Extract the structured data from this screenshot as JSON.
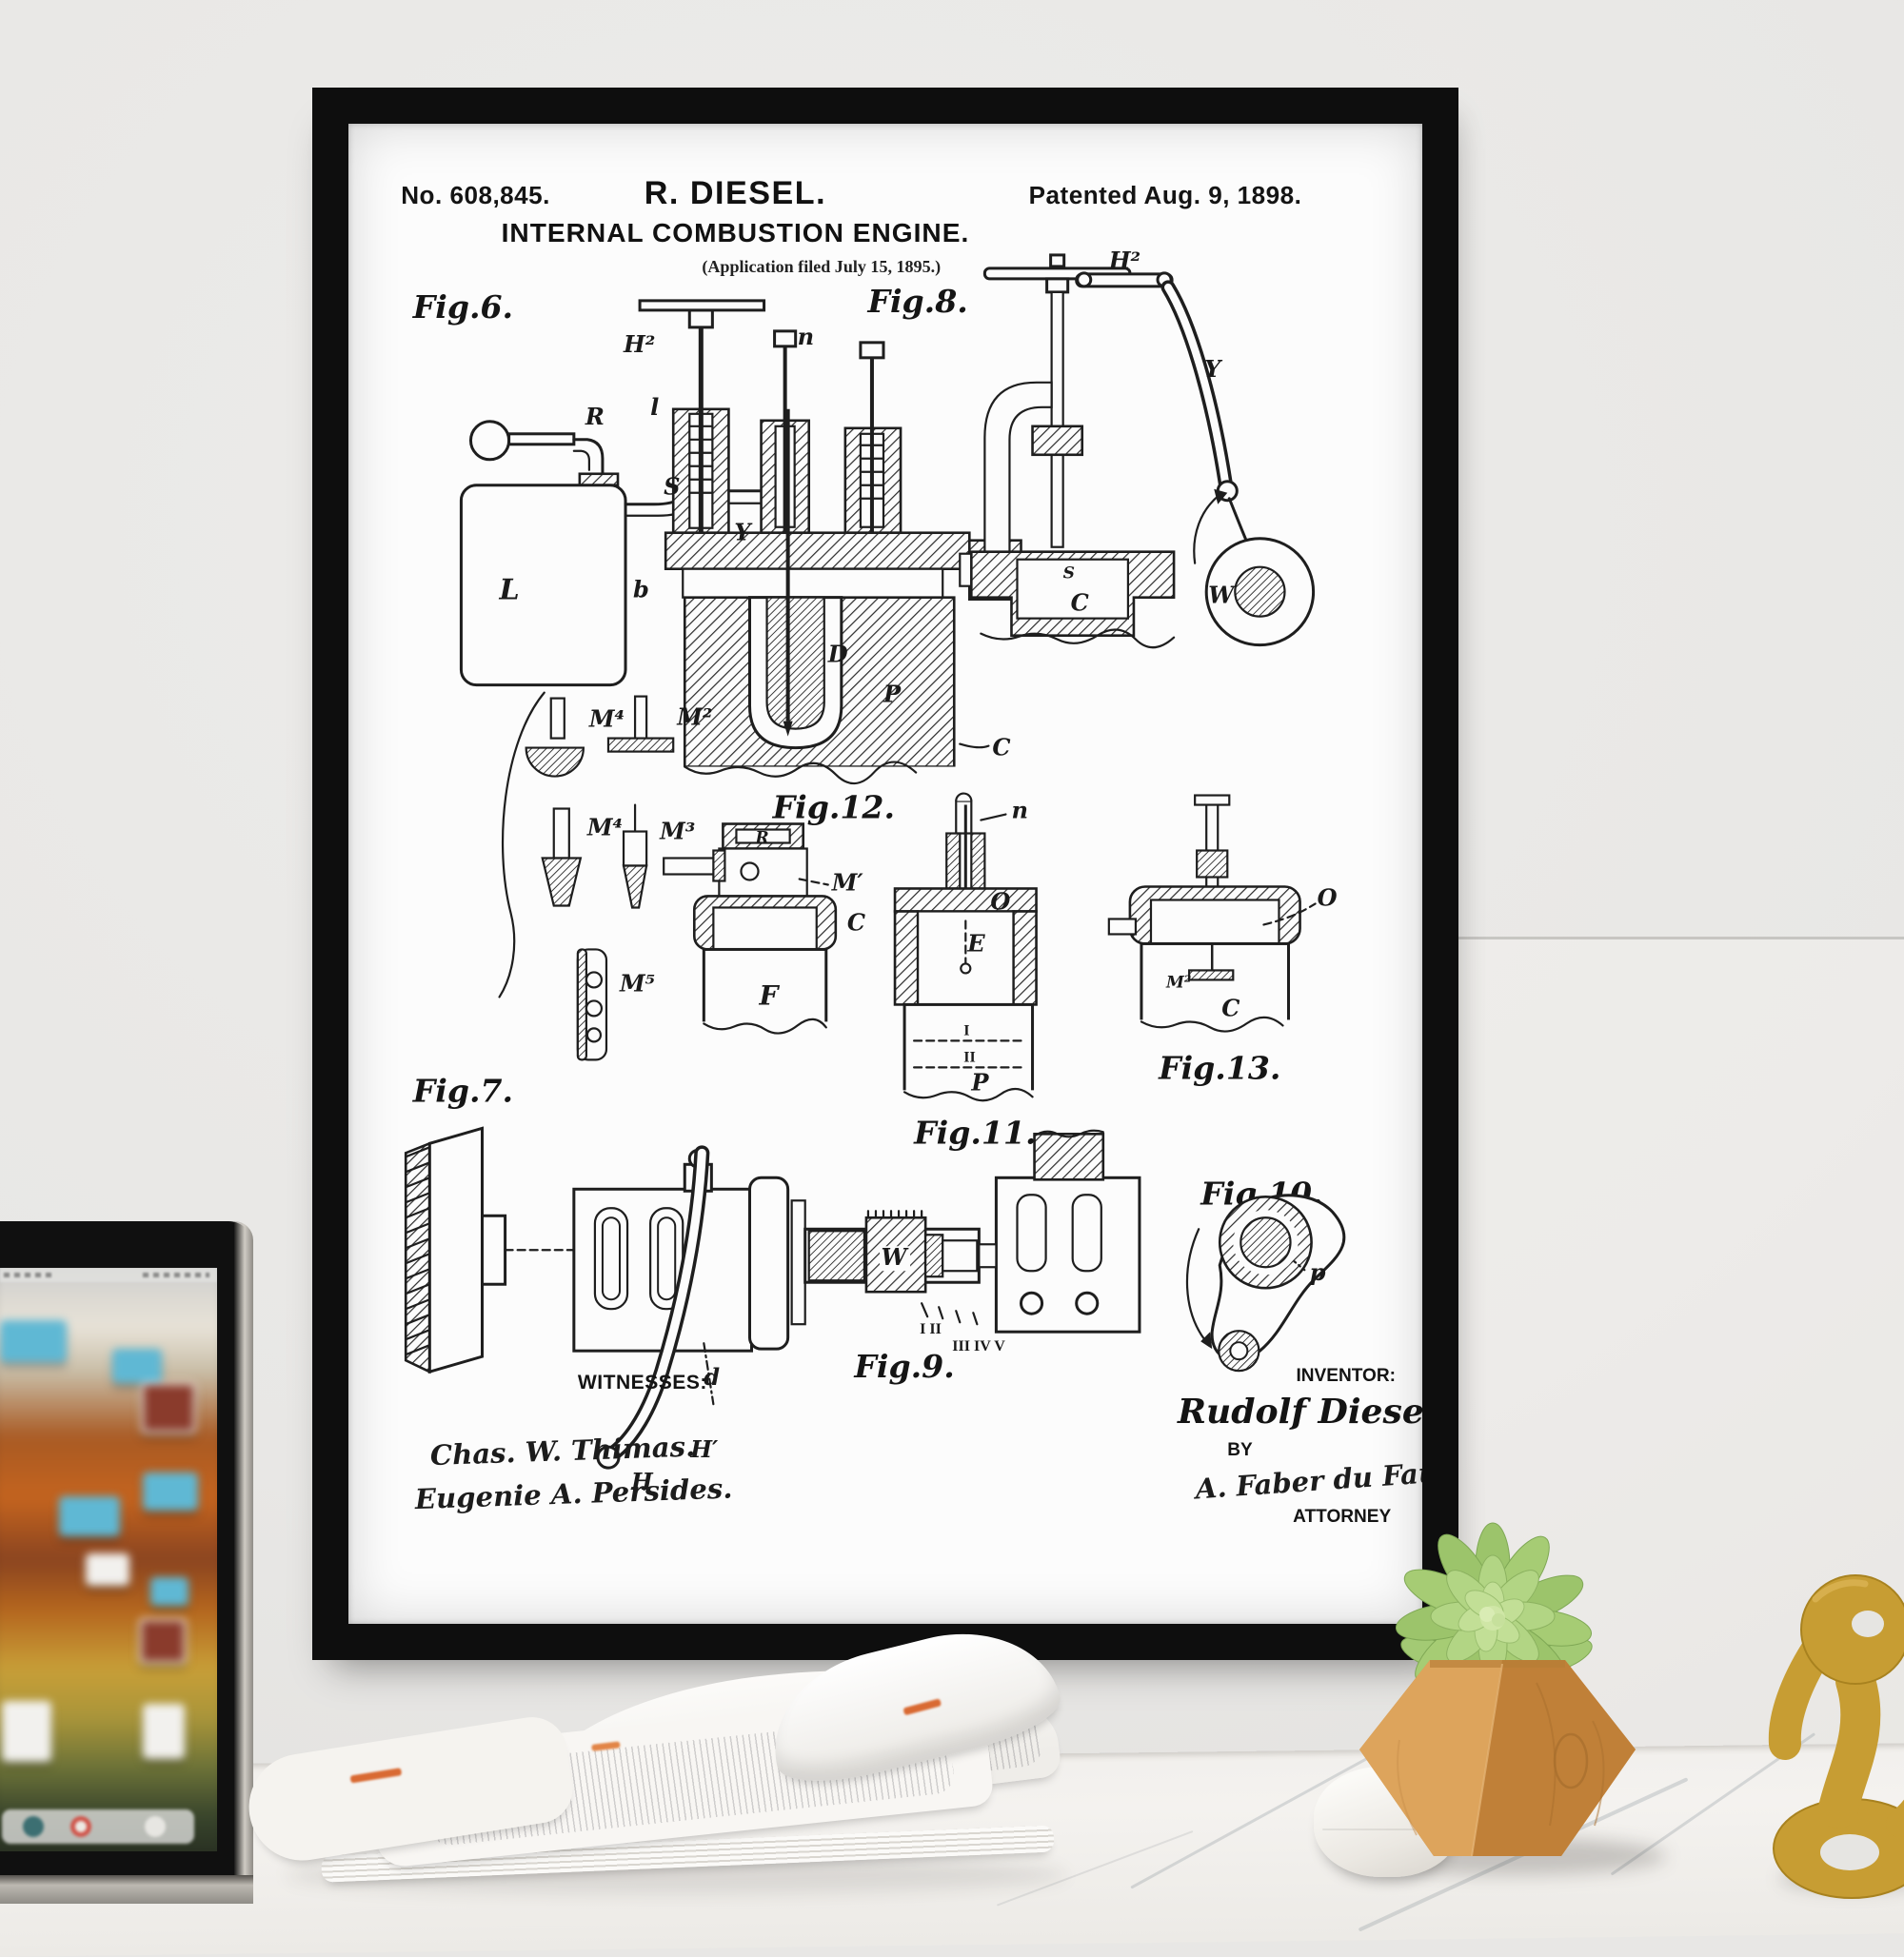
{
  "patent": {
    "number_label": "No. 608,845.",
    "name": "R. DIESEL.",
    "patented": "Patented Aug. 9, 1898.",
    "title": "INTERNAL COMBUSTION ENGINE.",
    "application": "(Application filed July 15, 1895.)",
    "figures": {
      "f6": "Fig.6.",
      "f7": "Fig.7.",
      "f8": "Fig.8.",
      "f9": "Fig.9.",
      "f10": "Fig.10.",
      "f11": "Fig.11.",
      "f12": "Fig.12.",
      "f13": "Fig.13."
    },
    "labels": {
      "L": "L",
      "R": "R",
      "S": "S",
      "b": "b",
      "l": "l",
      "Y": "Y",
      "V": "V",
      "D": "D",
      "P": "P",
      "C": "C",
      "n": "n",
      "H2": "H²",
      "W": "W",
      "O": "O",
      "E": "E",
      "F": "F",
      "I": "I",
      "II": "II",
      "M1": "M′",
      "M2": "M²",
      "M3": "M³",
      "M4": "M⁴",
      "M5": "M⁵",
      "H": "H",
      "H1": "H′",
      "d": "d",
      "p": "p",
      "roman_a": "I II",
      "roman_b": "III IV V"
    },
    "witnesses_label": "WITNESSES:",
    "witnesses": [
      "Chas. W. Thimas.",
      "Eugenie A. Persides."
    ],
    "inventor_label": "INVENTOR:",
    "inventor_name": "Rudolf Diesel,",
    "by_label": "BY",
    "attorney_signature": "A. Faber du Faur",
    "attorney_label": "ATTORNEY"
  },
  "colors": {
    "frame": "#0e0e0e",
    "paper": "#fcfcfc",
    "ink": "#1e1e1e",
    "wall": "#e8e7e5",
    "marble": "#f2f0ed",
    "pot_wood_light": "#dda45c",
    "pot_wood_dark": "#c08038",
    "succulent_green": "#9cc46b",
    "gold_accent": "#c79d33",
    "newspaper_accent": "#d96a33",
    "laptop_folder_blue": "#5fb8d4"
  }
}
